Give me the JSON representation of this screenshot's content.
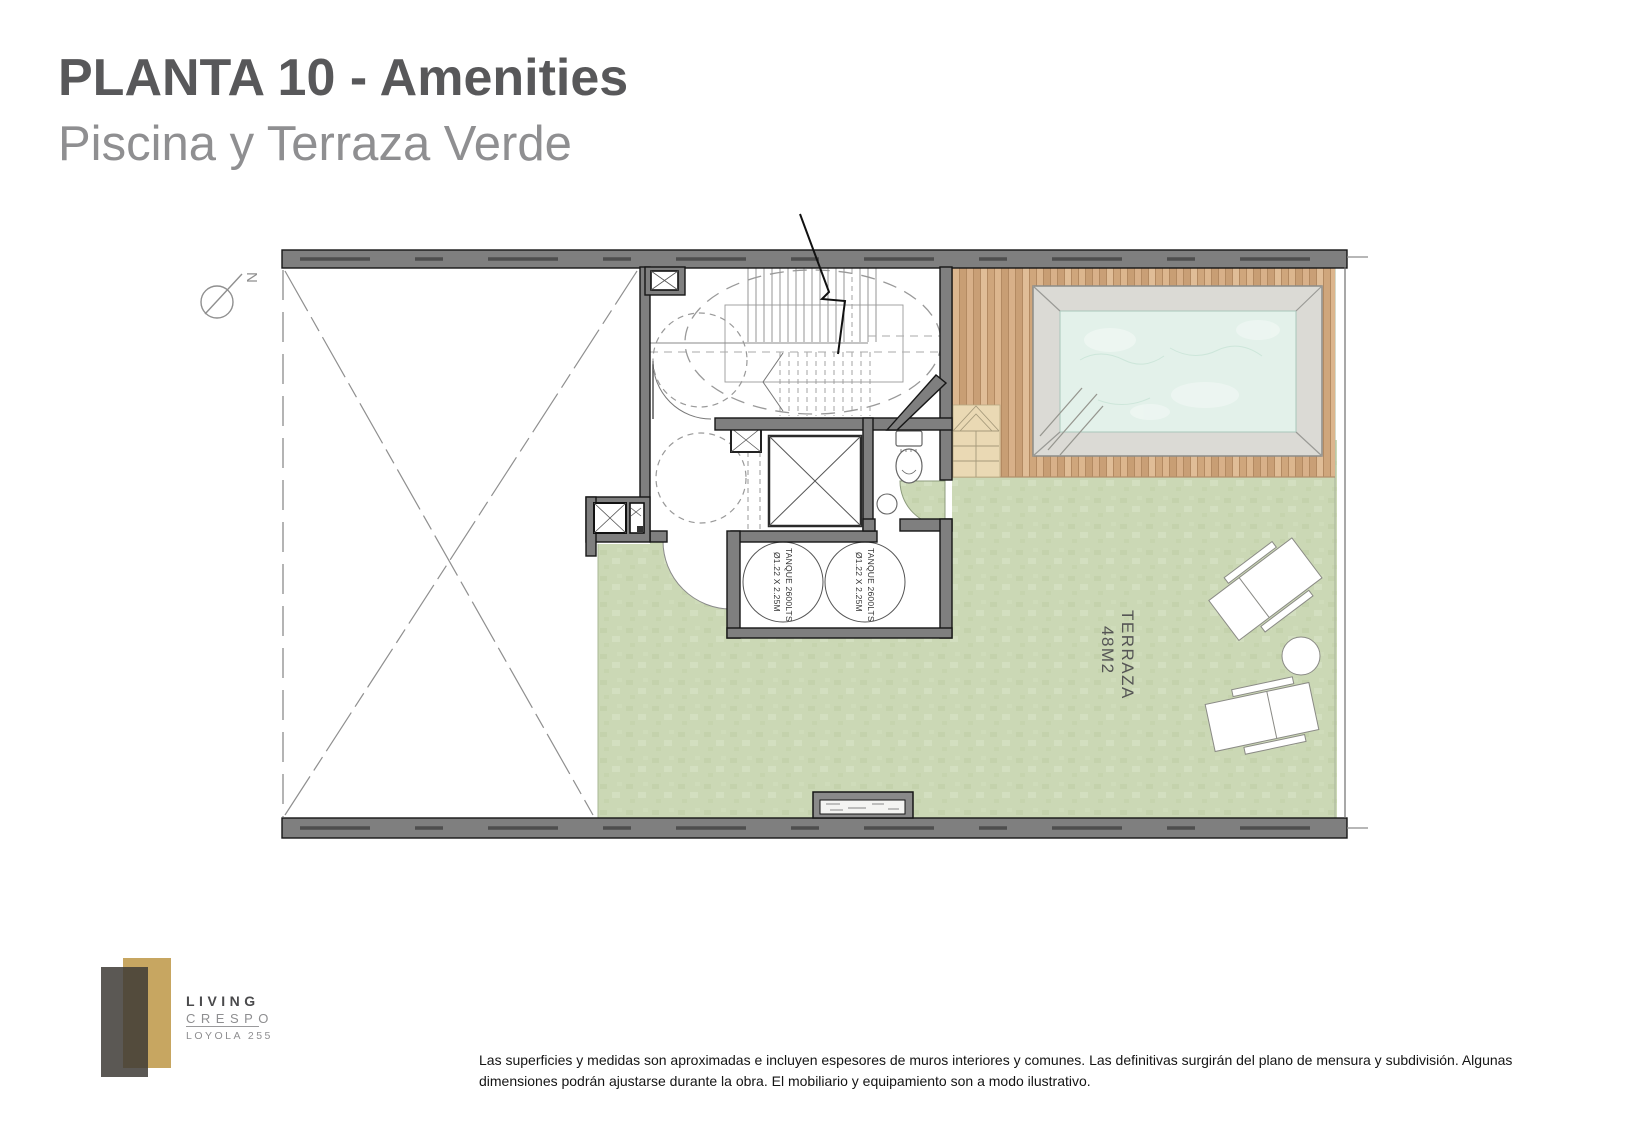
{
  "header": {
    "title": "PLANTA 10 - Amenities",
    "subtitle": "Piscina y Terraza Verde"
  },
  "plan": {
    "north_label": "N",
    "terrace_label": {
      "line1": "TERRAZA",
      "line2": "48M2"
    },
    "tanks": [
      {
        "line1": "TANQUE 2600LTS",
        "line2": "Ø1.22 X 2.25M"
      },
      {
        "line1": "TANQUE 2600LTS",
        "line2": "Ø1.22 X 2.25M"
      }
    ]
  },
  "logo": {
    "brand": "LIVING",
    "sub": "CRESPO",
    "address": "LOYOLA 255"
  },
  "footer": {
    "disclaimer_line1": "Las superficies y medidas son aproximadas e incluyen espesores de muros interiores y comunes. Las definitivas surgirán del plano de mensura y subdivisión. Algunas",
    "disclaimer_line2": "dimensiones podrán ajustarse durante la obra. El mobiliario y equipamiento son a modo ilustrativo."
  },
  "colors": {
    "title_gray": "#58585a",
    "subtitle_gray": "#8f8f91",
    "wall_gray": "#7f7f7f",
    "terrace_green": "#cbd8b5",
    "deck_wood": "#d2a87e",
    "pool_water": "#e3f1ea",
    "pool_frame": "#dbdad5",
    "steps_beige": "#ead9b4",
    "logo_gold": "#c7a661",
    "logo_dark": "#3e3b36"
  }
}
